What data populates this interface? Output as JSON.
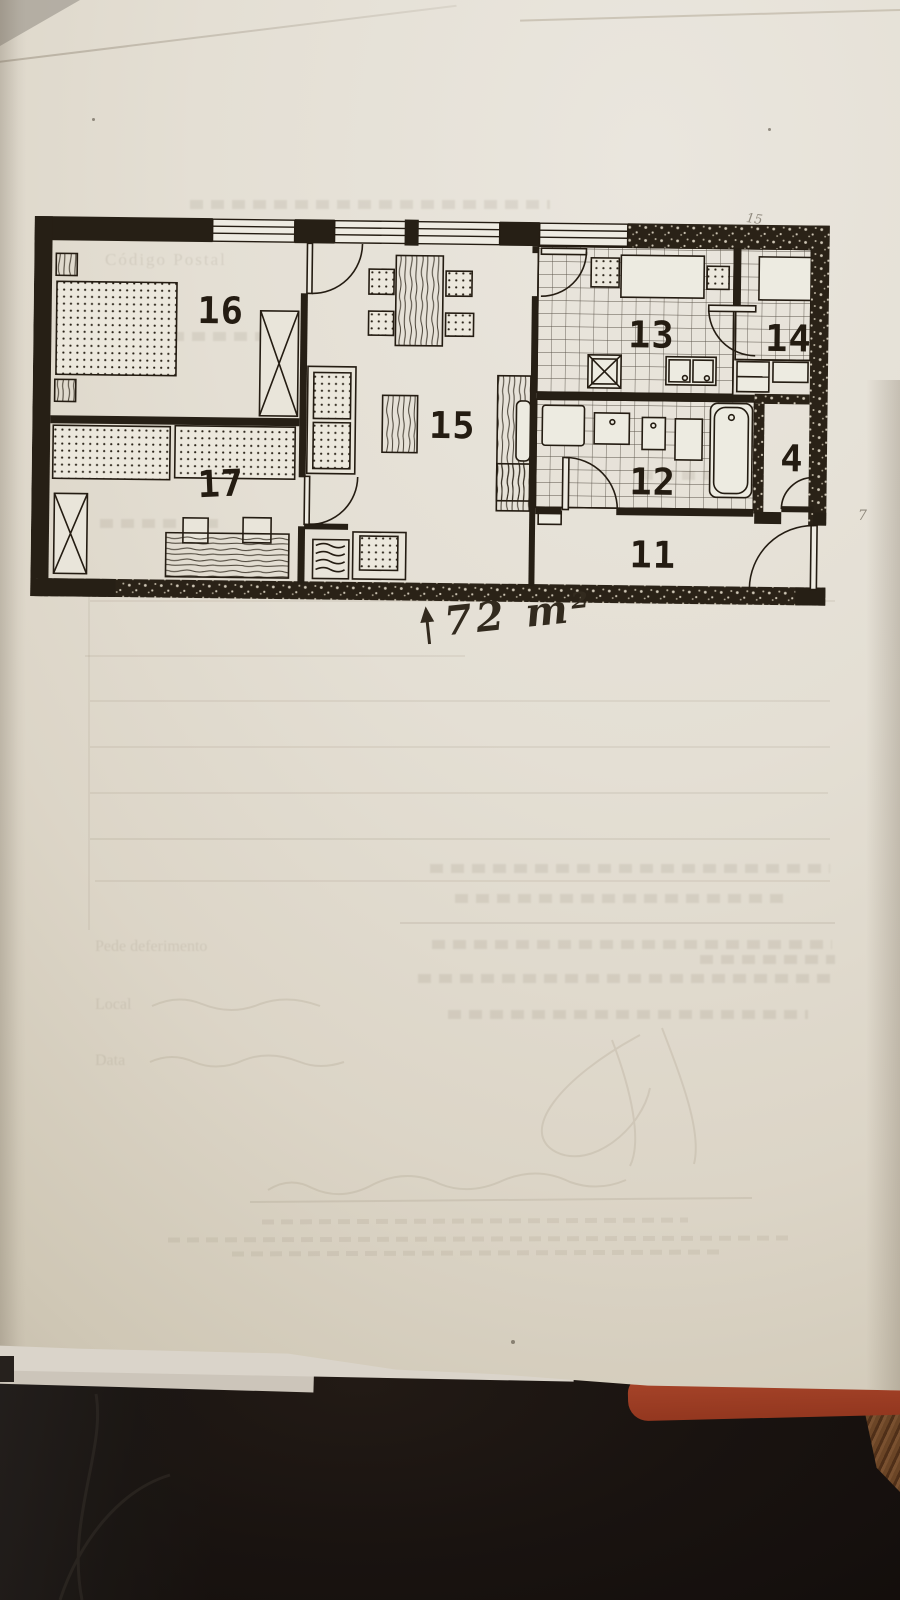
{
  "plan": {
    "labels": {
      "r16": "16",
      "r17": "17",
      "r15": "15",
      "r13": "13",
      "r14": "14",
      "r12": "12",
      "r11": "11",
      "r4": "4"
    },
    "area": {
      "arrow": "↑",
      "text": "72 m²"
    },
    "pencil_marks": {
      "above_plan": "15",
      "right_margin": "7"
    }
  },
  "ghost_text": {
    "codigo_postal": "Código Postal",
    "pede_deferimento": "Pede deferimento",
    "local": "Local",
    "data": "Data"
  },
  "colors": {
    "ink": "#241c12",
    "paper": "#e4dfd4",
    "paper_shadow": "#cfc7b5",
    "fabric": "#191310",
    "folder_orange": "#a8452a",
    "wood_brown": "#6b4526"
  }
}
